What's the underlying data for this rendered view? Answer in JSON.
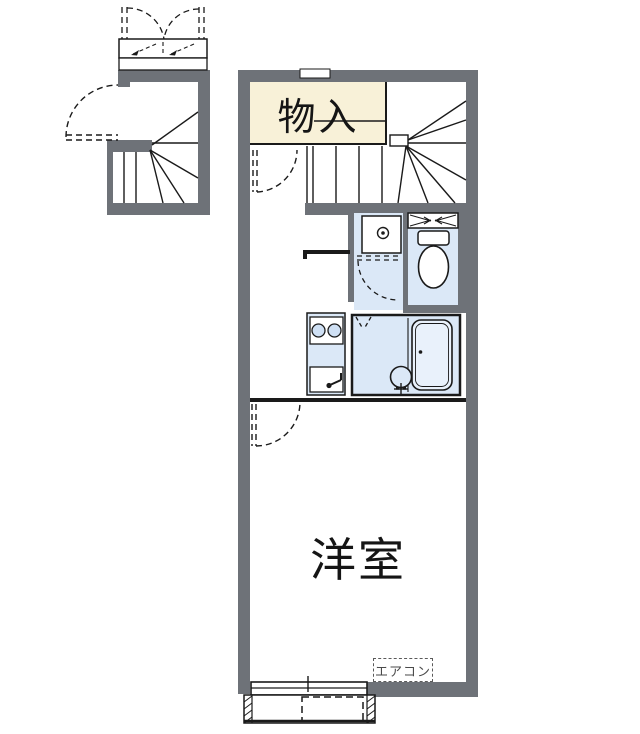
{
  "document": {
    "type": "apartment-floor-plan"
  },
  "labels": {
    "closet": "物入",
    "main_room": "洋室",
    "aircon": "エアコン"
  },
  "colors": {
    "wall_gray": "#6e7278",
    "closet_fill": "#f8f1d8",
    "wet_area_fill": "#dbe8f7",
    "bathtub_fill": "#e9f1fb",
    "line_black": "#1a1a1a",
    "aircon_text_gray": "#4a4a4a"
  }
}
